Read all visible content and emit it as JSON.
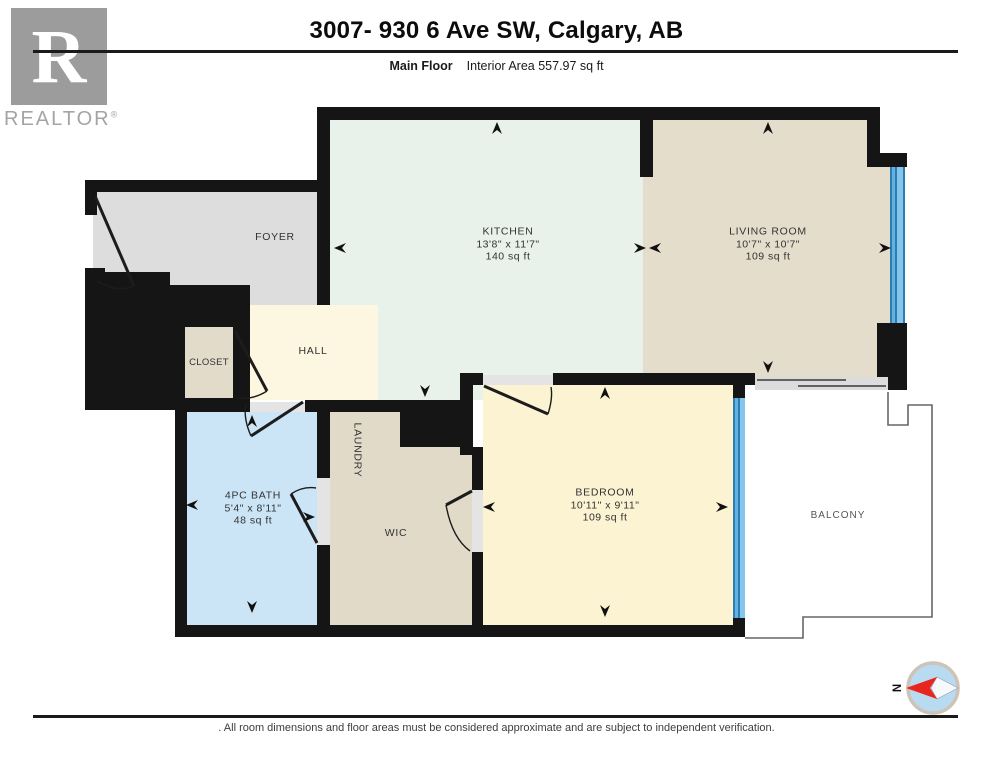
{
  "header": {
    "title": "3007- 930 6 Ave SW, Calgary, AB",
    "floor_label": "Main Floor",
    "area_label": "Interior Area 557.97 sq ft"
  },
  "logo": {
    "letter": "R",
    "brand": "REALTOR",
    "registered": "®"
  },
  "rooms": {
    "foyer": {
      "name": "FOYER"
    },
    "kitchen": {
      "name": "KITCHEN",
      "dims": "13'8\" x 11'7\"",
      "area": "140 sq ft"
    },
    "living": {
      "name": "LIVING ROOM",
      "dims": "10'7\" x 10'7\"",
      "area": "109 sq ft"
    },
    "hall": {
      "name": "HALL"
    },
    "closet": {
      "name": "CLOSET"
    },
    "bath": {
      "name": "4PC BATH",
      "dims": "5'4\" x 8'11\"",
      "area": "48 sq ft"
    },
    "laundry": {
      "name": "LAUNDRY"
    },
    "wic": {
      "name": "WIC"
    },
    "bedroom": {
      "name": "BEDROOM",
      "dims": "10'11\" x 9'11\"",
      "area": "109 sq ft"
    },
    "balcony": {
      "name": "BALCONY"
    }
  },
  "compass": {
    "north_label": "N"
  },
  "footer": {
    "disclaimer": ". All room dimensions and floor areas must be considered approximate and are subject to independent verification."
  },
  "colors": {
    "wall": "#151515",
    "foyer": "#dcdddc",
    "kitchen": "#e8f1ea",
    "living": "#e5ddcc",
    "hall": "#fdf6e0",
    "closet": "#e2dbca",
    "bath": "#cbe5f7",
    "laundry": "#e2dac9",
    "wic": "#e2dac9",
    "bedroom": "#fcf3d3",
    "window_blue": "#4f9fd3",
    "balcony_outline": "#666666",
    "compass_red": "#e8251f"
  }
}
